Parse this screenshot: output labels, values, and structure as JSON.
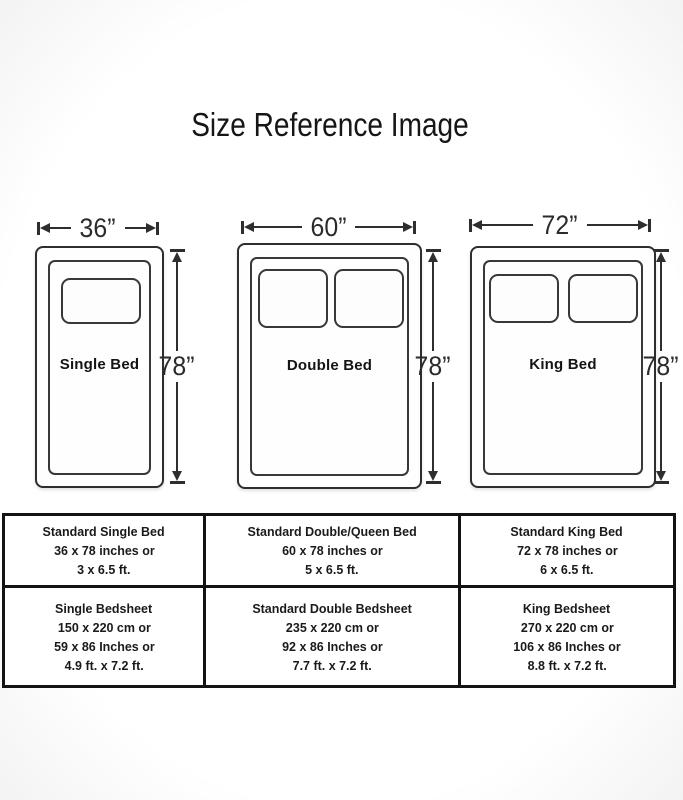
{
  "title": "Size Reference Image",
  "colors": {
    "line": "#2e2e2e",
    "text": "#1a1a1a",
    "table_border": "#131313",
    "background": "#ffffff"
  },
  "beds": [
    {
      "name": "Single Bed",
      "width_label": "36”",
      "height_label": "78”"
    },
    {
      "name": "Double Bed",
      "width_label": "60”",
      "height_label": "78”"
    },
    {
      "name": "King Bed",
      "width_label": "72”",
      "height_label": "78”"
    }
  ],
  "table": {
    "rows": [
      {
        "cells": [
          {
            "lines": [
              "Standard Single Bed",
              "36 x 78 inches or",
              "3 x 6.5 ft."
            ]
          },
          {
            "lines": [
              "Standard Double/Queen Bed",
              "60 x 78 inches or",
              "5 x 6.5 ft."
            ]
          },
          {
            "lines": [
              "Standard King Bed",
              "72 x 78 inches or",
              "6 x 6.5 ft."
            ]
          }
        ]
      },
      {
        "cells": [
          {
            "lines": [
              "Single Bedsheet",
              "150 x 220 cm or",
              "59 x 86 Inches or",
              "4.9 ft. x 7.2 ft."
            ]
          },
          {
            "lines": [
              "Standard Double Bedsheet",
              "235 x 220 cm or",
              "92 x 86 Inches or",
              "7.7 ft. x 7.2 ft."
            ]
          },
          {
            "lines": [
              "King Bedsheet",
              "270 x 220 cm or",
              "106 x 86 Inches or",
              "8.8 ft. x 7.2 ft."
            ]
          }
        ]
      }
    ]
  }
}
